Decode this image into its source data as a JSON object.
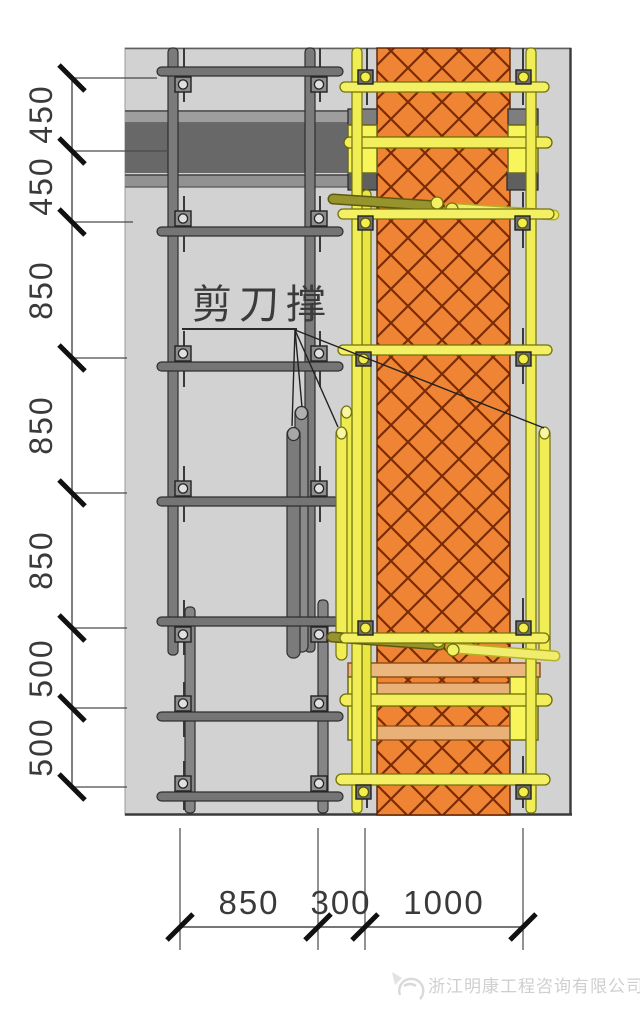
{
  "drawing": {
    "title_note": "scaffold and column formwork elevation detail",
    "annotation": {
      "scissor_brace_label": "剪刀撑"
    },
    "left_dimensions": {
      "values": [
        "450",
        "450",
        "850",
        "850",
        "850",
        "500",
        "500"
      ]
    },
    "bottom_dimensions": {
      "values": [
        "850",
        "300",
        "1000"
      ]
    },
    "watermark": {
      "company": "浙江明康工程咨询有限公司"
    },
    "colors": {
      "wall_panel": "#d2d2d2",
      "beam_dark": "#686868",
      "slab_gray": "#9e9e9e",
      "column_orange": "#ef8434",
      "hatch_brown": "#7a2b05",
      "formwork_yellow": "#f3f065",
      "tube_gray": "#7b7b7b",
      "brace_olive": "#97942e"
    }
  }
}
